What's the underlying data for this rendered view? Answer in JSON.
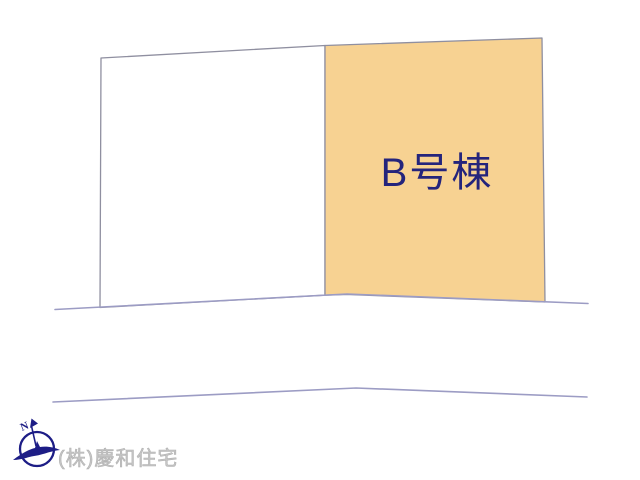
{
  "diagram": {
    "parcel_b_label": "B号棟",
    "colors": {
      "parcel_b_fill": "#f7d292",
      "parcel_a_fill": "#ffffff",
      "parcel_label": "#24247c",
      "boundary_line": "#8f8fa0",
      "road_line": "#9c9cc4",
      "logo_navy": "#1d1d86",
      "company_text": "#c6c6c6"
    }
  },
  "footer": {
    "company_name": "(株)慶和住宅",
    "compass_n_label": "N"
  }
}
